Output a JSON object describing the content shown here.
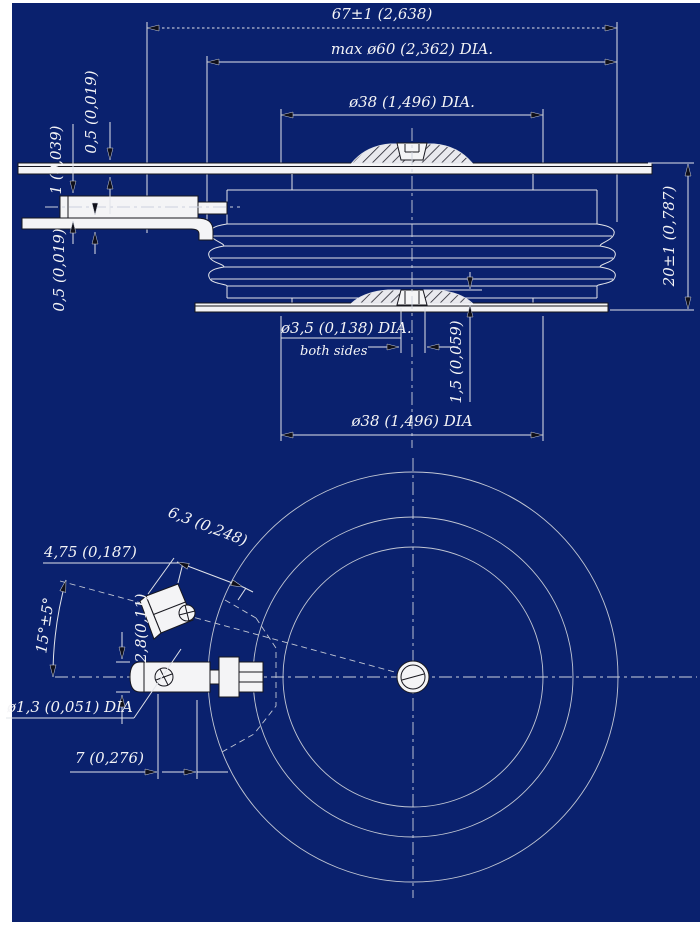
{
  "drawing": {
    "background_color": "#0A216E",
    "line_color": "#E2E4EA",
    "text_color": "#F4F4F6",
    "side_view": {
      "dim_overall_width": "67±1 (2,638)",
      "dim_max_diameter": "max ø60 (2,362) DIA.",
      "dim_pole_diameter_top": "ø38 (1,496) DIA.",
      "dim_pole_diameter_bottom": "ø38 (1,496) DIA",
      "dim_height": "20±1 (0,787)",
      "dim_top_lead_thickness": "0,5 (0,019)",
      "dim_gate_tube": "1 (0,039)",
      "dim_gate_lead_thickness": "0,5 (0,019)",
      "dim_center_hole": "ø3,5 (0,138) DIA.",
      "dim_center_hole_note": "both sides",
      "dim_pole_recess": "1,5 (0,059)"
    },
    "plan_view": {
      "dim_connector_width": "4,75 (0,187)",
      "dim_connector_length": "6,3 (0,248)",
      "dim_gate_angle": "15°±5°",
      "dim_terminal_thickness": "2,8(0,11)",
      "dim_gate_wire_diameter": "ø1,3 (0,051) DIA",
      "dim_terminal_offset": "7 (0,276)"
    }
  }
}
